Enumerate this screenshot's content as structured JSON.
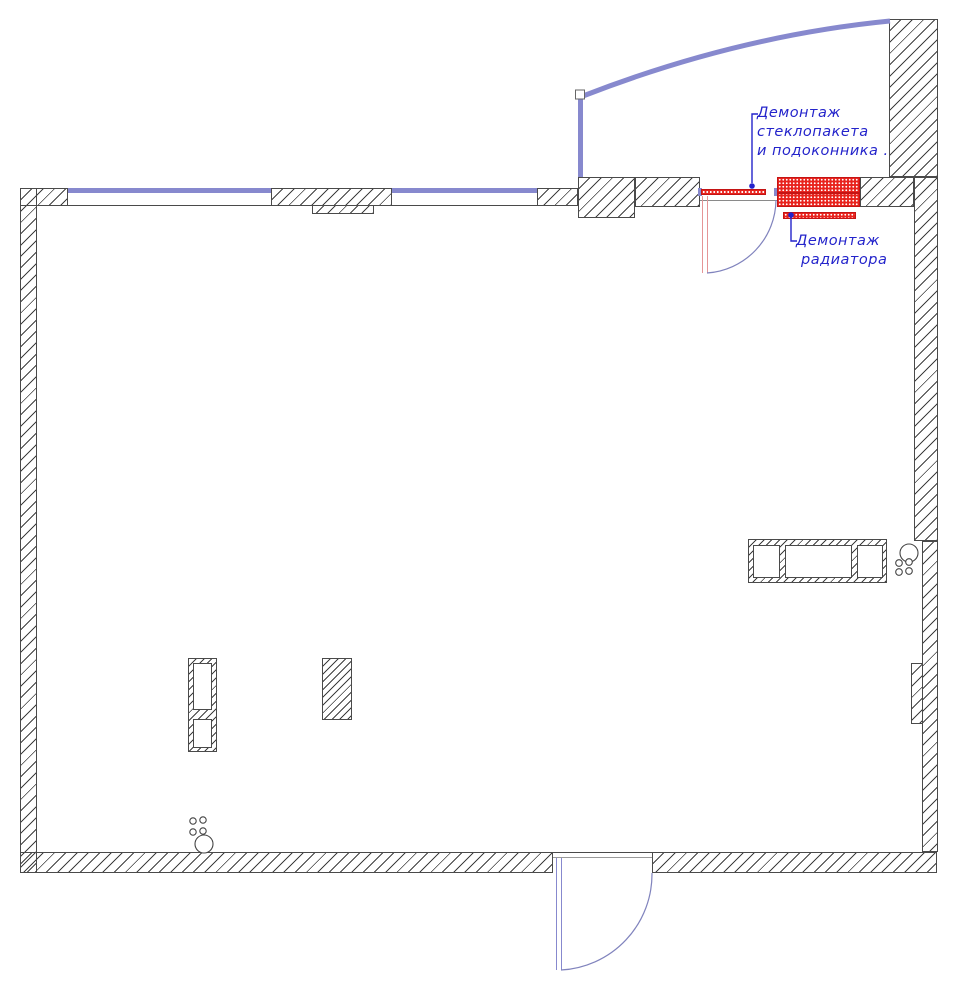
{
  "drawing": {
    "title": "floor-plan-demolition",
    "annotations": {
      "window_demolition": {
        "lines": [
          "Демонтаж",
          "стеклопакета",
          "и подоконника ."
        ]
      },
      "radiator_demolition": {
        "lines": [
          "Демонтаж",
          "радиатора"
        ]
      }
    },
    "colors": {
      "outline": "#4a4a4a",
      "hatch_line": "#3f3f3f",
      "window_blue": "#8789ce",
      "door_arc_blue": "#8083bd",
      "door_leaf_pink": "#e59596",
      "demolition_red": "#e8231d",
      "demolition_red_dark": "#c41414",
      "annotation_blue": "#2424cb"
    }
  }
}
